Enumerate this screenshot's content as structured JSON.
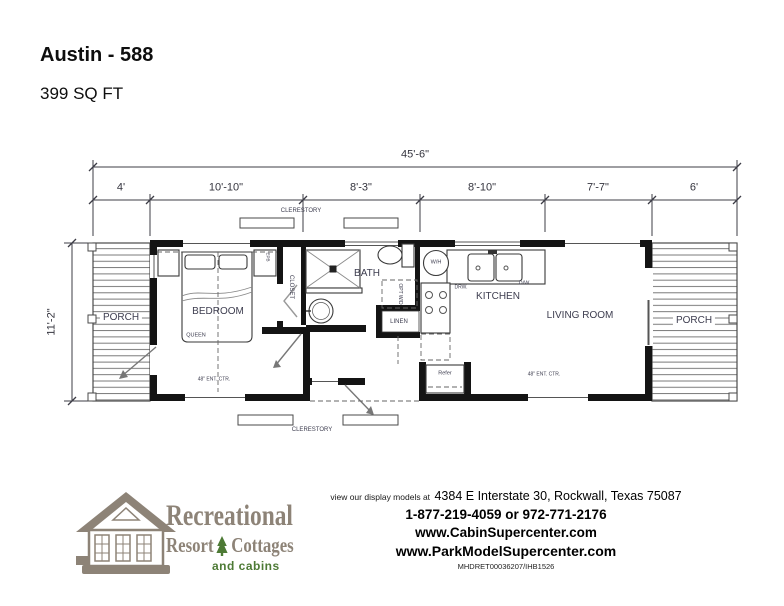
{
  "header": {
    "title": "Austin - 588",
    "subtitle": "399 SQ FT"
  },
  "plan": {
    "dimensions": {
      "overall_width": "45'-6\"",
      "height": "11'-2\"",
      "segments": [
        "4'",
        "10'-10\"",
        "8'-3\"",
        "8'-10\"",
        "7'-7\"",
        "6'"
      ]
    },
    "labels": {
      "clerestory_top": "CLERESTORY",
      "clerestory_bottom": "CLERESTORY",
      "porch_left": "PORCH",
      "porch_right": "PORCH",
      "bedroom": "BEDROOM",
      "queen": "QUEEN",
      "closet": "CLOSET",
      "epb": "EPB",
      "bath": "BATH",
      "opt_wd": "OPT W/D",
      "linen": "LINEN",
      "wh": "W/H",
      "drw": "DRW.",
      "dw": "D/W",
      "kitchen": "KITCHEN",
      "living_room": "LIVING ROOM",
      "refer": "Refer",
      "ent_ctr_bedroom": "48\" ENT. CTR.",
      "ent_ctr_living": "48\" ENT. CTR."
    }
  },
  "footer": {
    "logo": {
      "name": "Recreational",
      "resort": "Resort",
      "cottages": "Cottages",
      "tagline": "and cabins",
      "taupe_color": "#8d8377",
      "green_color": "#4d7a35"
    },
    "address_prefix": "view our display models at",
    "address": "4384 E Interstate 30, Rockwall, Texas 75087",
    "phone": "1-877-219-4059 or 972-771-2176",
    "website1": "www.CabinSupercenter.com",
    "website2": "www.ParkModelSupercenter.com",
    "code": "MHDRET00036207/IHB1526"
  }
}
